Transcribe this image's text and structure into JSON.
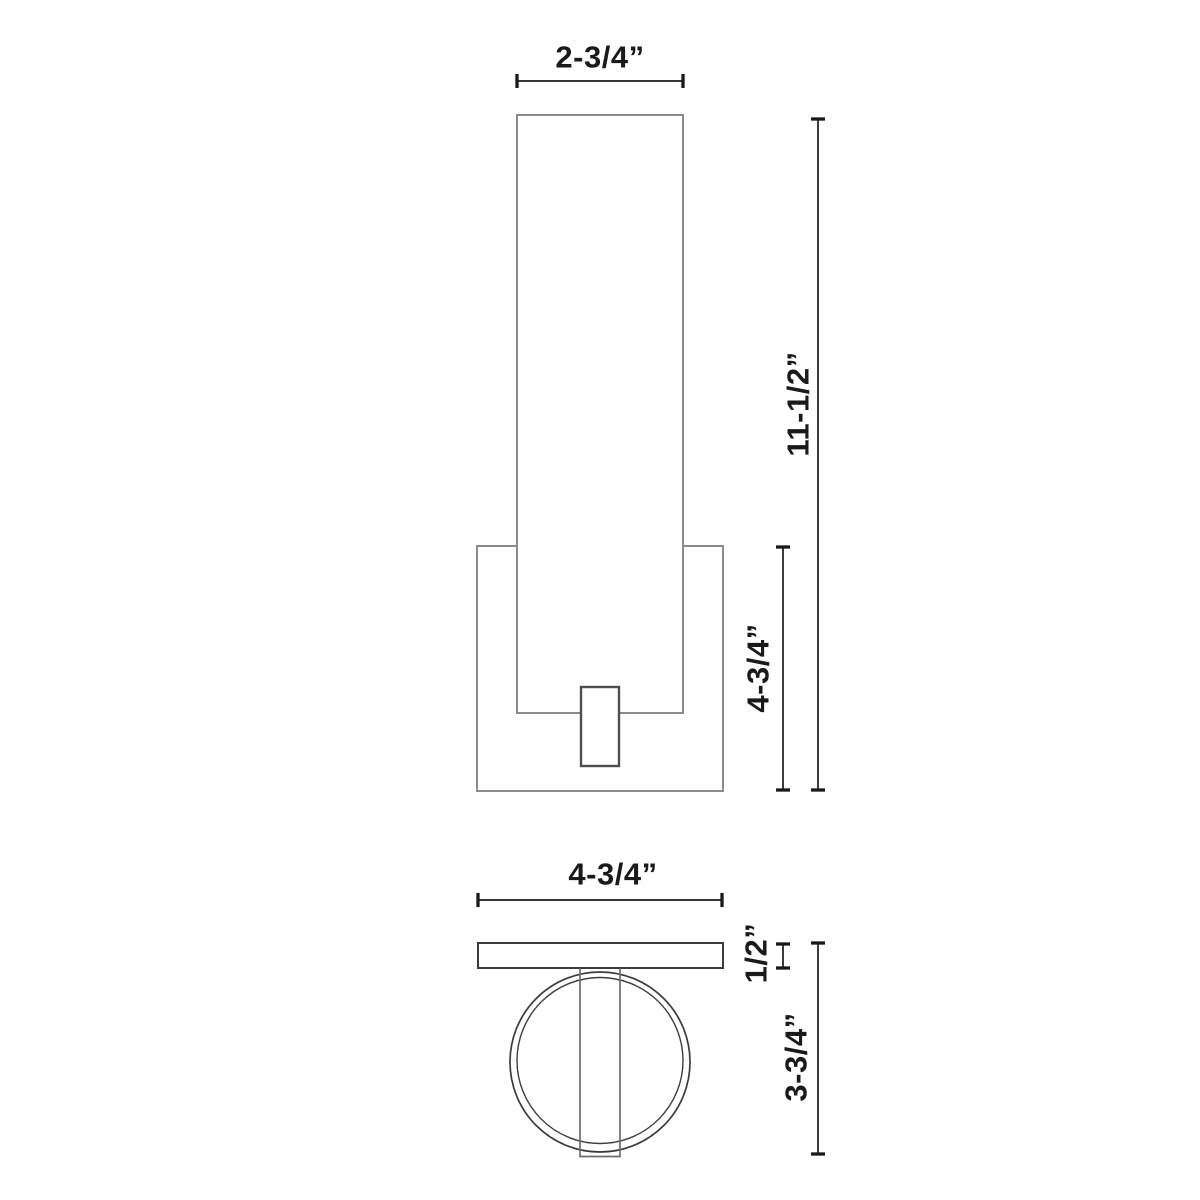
{
  "drawing": {
    "dimensions": {
      "shade_width": "2-3/4”",
      "overall_height": "11-1/2”",
      "backplate_height": "4-3/4”",
      "plate_width": "4-3/4”",
      "plate_depth": "1/2”",
      "overall_depth": "3-3/4”"
    },
    "colors": {
      "fixture_outline": "#8c8c8c",
      "stem_outline": "#4f4f4f",
      "plan_outline": "#3c3c3c",
      "plan_stem_outline": "#6e6e6e",
      "dimension": "#1a1a1a",
      "background": "#ffffff"
    }
  }
}
